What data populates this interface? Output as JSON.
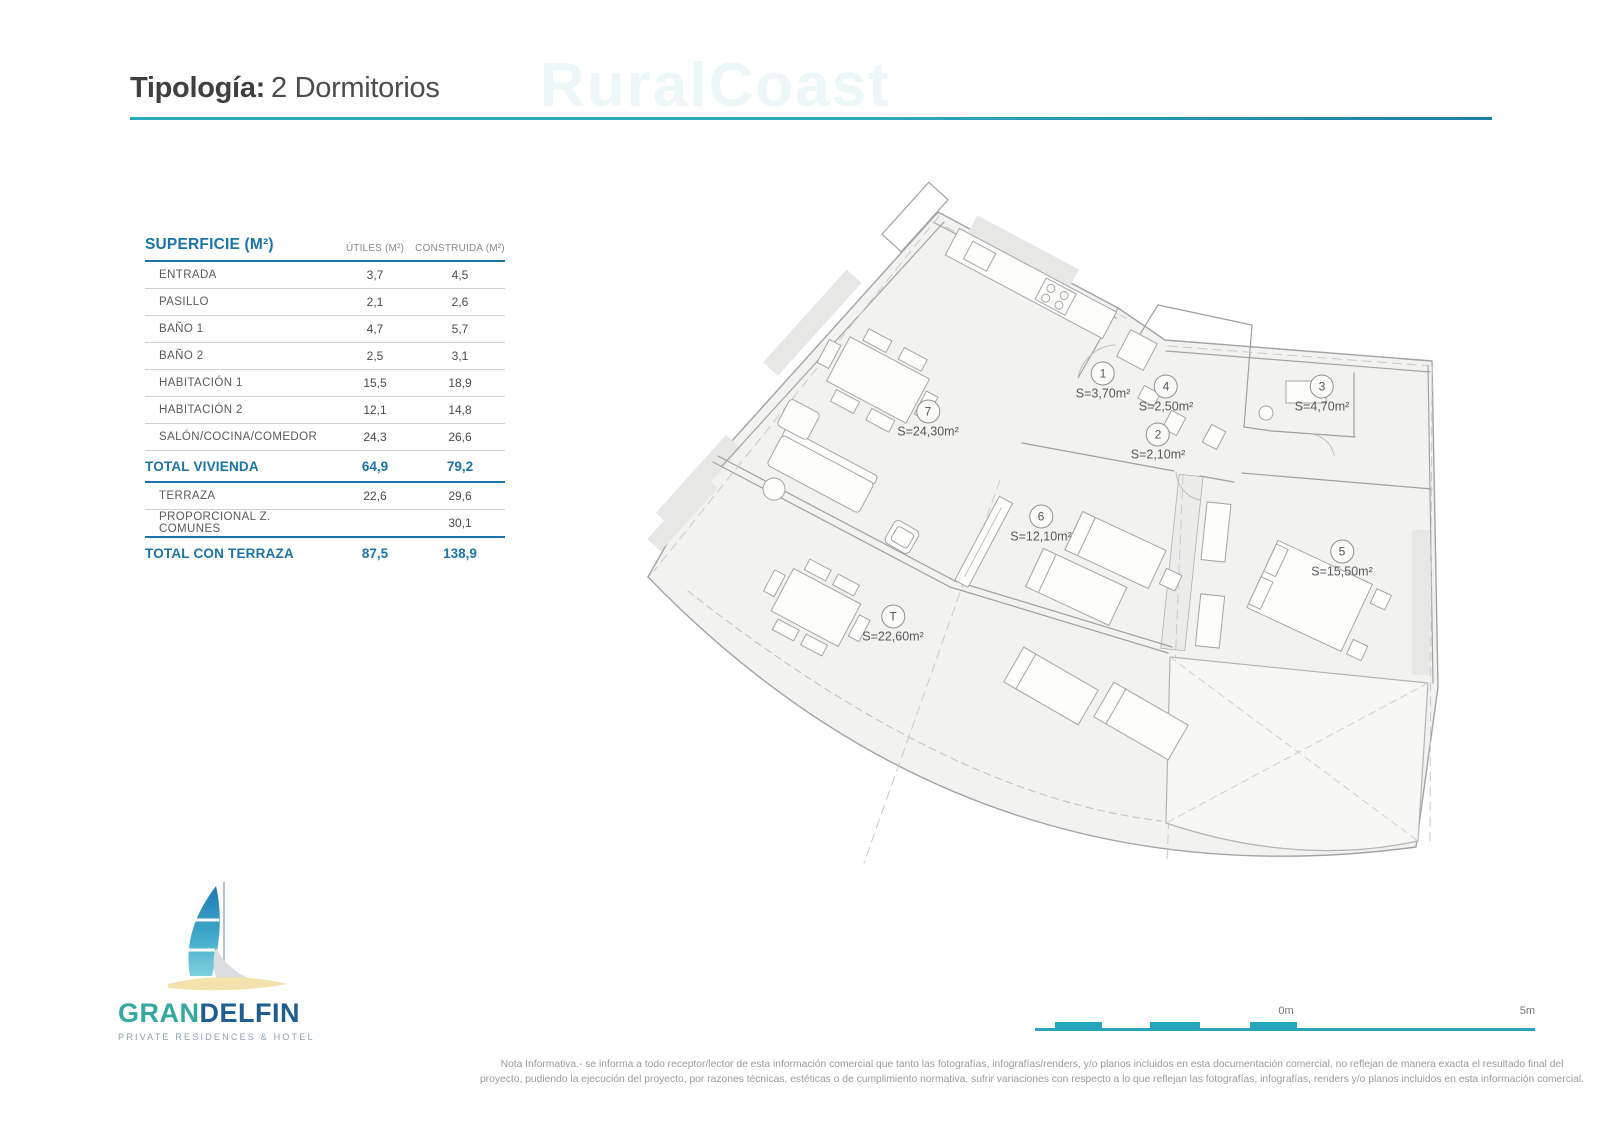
{
  "title": {
    "label": "Tipología:",
    "value": "2 Dormitorios"
  },
  "watermark": "RuralCoast",
  "table": {
    "header": "SUPERFICIE (M²)",
    "col_utiles": "ÚTILES (M²)",
    "col_construida": "CONSTRUIDA (M²)",
    "rows": [
      {
        "label": "ENTRADA",
        "utiles": "3,7",
        "construida": "4,5"
      },
      {
        "label": "PASILLO",
        "utiles": "2,1",
        "construida": "2,6"
      },
      {
        "label": "BAÑO 1",
        "utiles": "4,7",
        "construida": "5,7"
      },
      {
        "label": "BAÑO 2",
        "utiles": "2,5",
        "construida": "3,1"
      },
      {
        "label": "HABITACIÓN 1",
        "utiles": "15,5",
        "construida": "18,9"
      },
      {
        "label": "HABITACIÓN 2",
        "utiles": "12,1",
        "construida": "14,8"
      },
      {
        "label": "SALÓN/COCINA/COMEDOR",
        "utiles": "24,3",
        "construida": "26,6"
      },
      {
        "label": "TOTAL VIVIENDA",
        "utiles": "64,9",
        "construida": "79,2"
      },
      {
        "label": "TERRAZA",
        "utiles": "22,6",
        "construida": "29,6"
      },
      {
        "label": "PROPORCIONAL Z. COMUNES",
        "utiles": "",
        "construida": "30,1"
      },
      {
        "label": "TOTAL CON TERRAZA",
        "utiles": "87,5",
        "construida": "138,9"
      }
    ]
  },
  "plan": {
    "labels": [
      {
        "id": "1",
        "area": "S=3,70m²"
      },
      {
        "id": "4",
        "area": "S=2,50m²"
      },
      {
        "id": "3",
        "area": "S=4,70m²"
      },
      {
        "id": "2",
        "area": "S=2,10m²"
      },
      {
        "id": "7",
        "area": "S=24,30m²"
      },
      {
        "id": "6",
        "area": "S=12,10m²"
      },
      {
        "id": "5",
        "area": "S=15,50m²"
      },
      {
        "id": "T",
        "area": "S=22,60m²"
      }
    ]
  },
  "logo": {
    "name_part1": "GRAN",
    "name_part2": "DELFIN",
    "tagline": "PRIVATE RESIDENCES & HOTEL"
  },
  "scale": {
    "zero": "0m",
    "five": "5m"
  },
  "footer": {
    "line1": "Nota Informativa.- se informa a todo receptor/lector de esta información comercial que tanto las fotografías, infografías/renders, y/o planos incluidos en esta documentación comercial, no reflejan de manera exacta el resultado final del",
    "line2": "proyecto, pudiendo la ejecución del proyecto, por razones técnicas, estéticas o de cumplimiento normativa, sufrir variaciones con respecto a lo que reflejan las fotografías, infografías, renders y/o planos incluidos en esta información comercial."
  },
  "colors": {
    "accent_teal": "#2BA9BD",
    "table_blue": "#1B74A9",
    "logo_teal": "#35A8A1",
    "logo_navy": "#1F5E92"
  }
}
